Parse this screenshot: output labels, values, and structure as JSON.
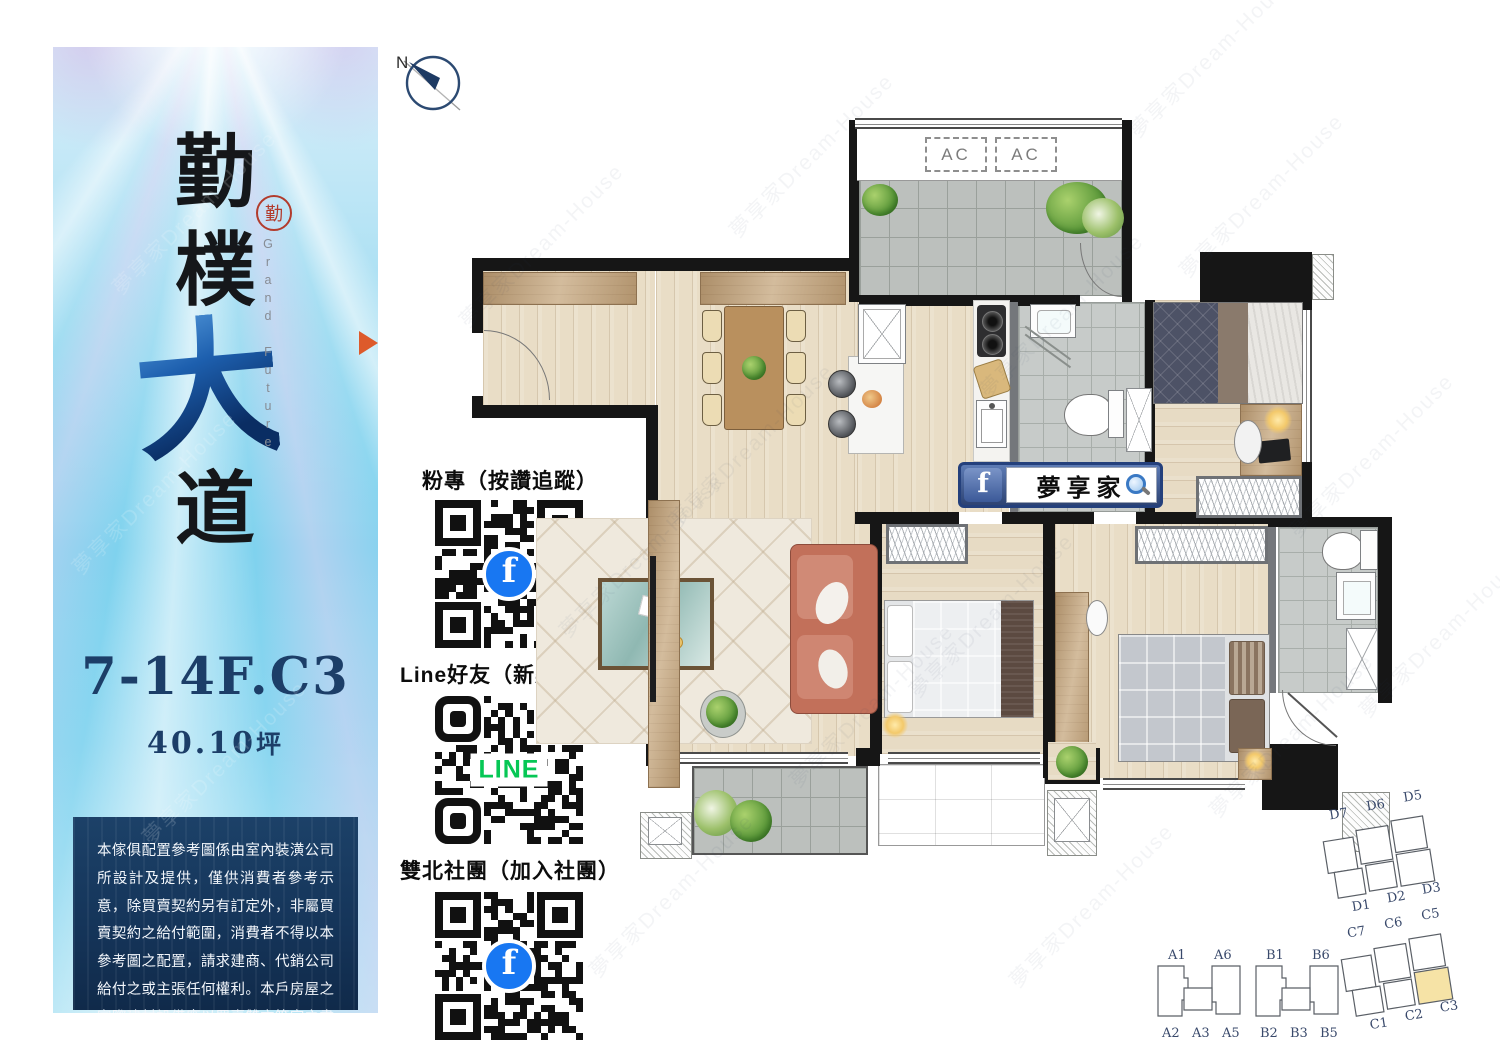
{
  "banner": {
    "title_chars": [
      "勤",
      "樸",
      "大",
      "道"
    ],
    "seal_char": "勤",
    "subtitle": "Grand Future",
    "unit_label": "7-14F.C3",
    "area_label": "40.10",
    "area_unit": "坪",
    "disclaimer": "本傢俱配置參考圖係由室內裝潢公司所設計及提供，僅供消費者參考示意，除買賣契約另有訂定外，非屬買賣契約之給付範圍，消費者不得以本參考圖之配置，請求建商、代銷公司給付之或主張任何權利。本戶房屋之實際建材設備應以買賣雙方簽定之書面房屋預定買賣契約書暨其附件所載之約定及條款為依據。"
  },
  "qr_section": {
    "items": [
      {
        "label": "粉專（按讚追蹤）",
        "platform": "facebook",
        "logo_letter": "f"
      },
      {
        "label": "Line好友（新案廣播）",
        "platform": "line",
        "center_text": "LINE"
      },
      {
        "label": "雙北社團（加入社團）",
        "platform": "facebook",
        "logo_letter": "f"
      }
    ]
  },
  "floorplan": {
    "compass_label": "N",
    "ac_units": [
      "AC",
      "AC"
    ],
    "fb_badge_text": "夢享家"
  },
  "keyplans": {
    "blocks": [
      {
        "name": "A",
        "top_labels": [
          "A1",
          "A6"
        ],
        "bottom_labels": [
          "A2",
          "A3",
          "A5"
        ]
      },
      {
        "name": "B",
        "top_labels": [
          "B1",
          "B6"
        ],
        "bottom_labels": [
          "B2",
          "B3",
          "B5"
        ]
      },
      {
        "name": "C",
        "top_labels": [
          "C7",
          "C6",
          "C5"
        ],
        "bottom_labels": [
          "C1",
          "C2",
          "C3"
        ],
        "highlighted_unit": "C3"
      },
      {
        "name": "D",
        "top_labels": [
          "D7",
          "D6",
          "D5"
        ],
        "bottom_labels": [
          "D1",
          "D2",
          "D3"
        ]
      }
    ]
  },
  "watermark_text": "夢享家Dream-House",
  "colors": {
    "accent_orange": "#dd5a2b",
    "navy": "#1c3e68",
    "facebook_blue": "#1877f2",
    "line_green": "#06c755",
    "highlighted_unit_fill": "#f6e3a6",
    "seal_red": "#b23b2c"
  }
}
